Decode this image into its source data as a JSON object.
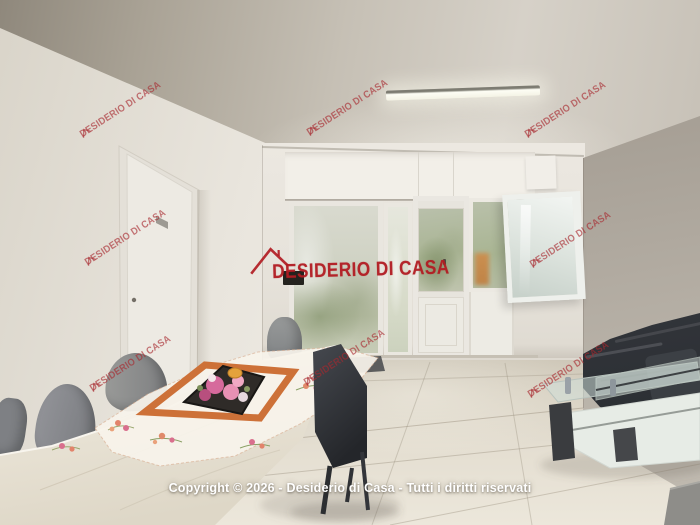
{
  "brand": {
    "watermark_text": "DESIDERIO DI CASA",
    "watermark_color": "#b2252b",
    "logo_icon": "roof-outline-icon"
  },
  "footer": {
    "copyright_text": "Copyright © 2026 - Desiderio di Casa - Tutti i diritti riservati",
    "text_color": "#ffffff"
  },
  "scene": {
    "alt": "Bright living-dining room: white walls, glazed sliding doors, left interior door, grey dining chairs around a stone table with embroidered runner and flower plate, dark grey sofa and glass coffee table on beige tile floor"
  },
  "palette": {
    "ceiling": "#c9c3b9",
    "left_wall": "#f0ece5",
    "back_wall": "#e9e5dd",
    "right_wall": "#aaa49a",
    "floor": "#ddd6c8",
    "sofa": "#383b41",
    "chair_grey": "#8a8b8f",
    "table_stone": "#e8e2d6",
    "runner_orange": "#cd7138"
  }
}
